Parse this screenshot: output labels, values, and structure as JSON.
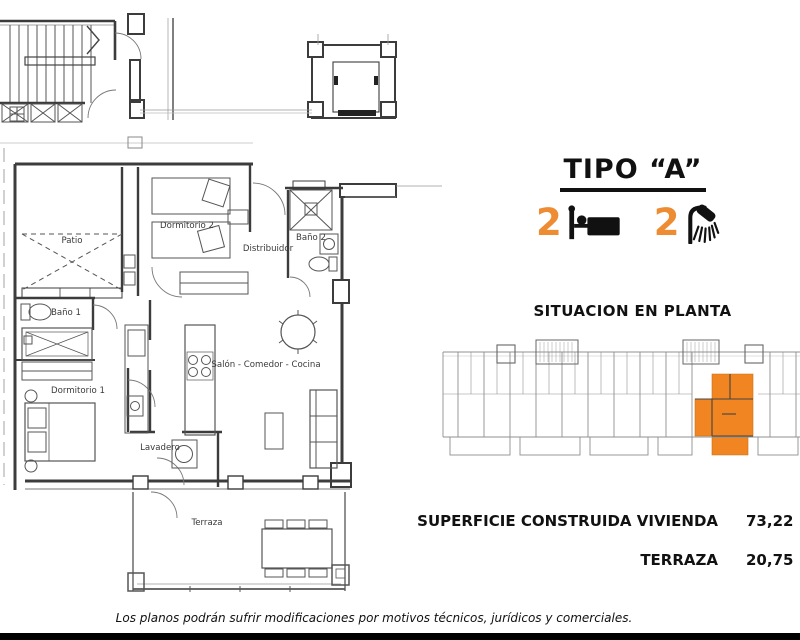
{
  "header": {
    "title": "TIPO “A”"
  },
  "features": {
    "bedrooms": "2",
    "bathrooms": "2",
    "bed_icon": "bed-icon",
    "shower_icon": "shower-icon"
  },
  "situation": {
    "heading": "SITUACION EN PLANTA"
  },
  "areas": {
    "vivienda_label": "SUPERFICIE CONSTRUIDA VIVIENDA",
    "vivienda_value": "73,22 M",
    "terraza_label": "TERRAZA",
    "terraza_value": "20,75 M"
  },
  "plan": {
    "labels": {
      "patio": "Patio",
      "dormitorio2": "Dormitorio 2",
      "bano2": "Baño 2",
      "distribuidor": "Distribuidor",
      "bano1": "Baño 1",
      "salon": "Salón - Comedor - Cocina",
      "dormitorio1": "Dormitorio 1",
      "lavadero": "Lavadero",
      "terraza": "Terraza"
    }
  },
  "footer": {
    "disclaimer": "Los planos podrán sufrir modificaciones por motivos técnicos, jurídicos y comerciales."
  },
  "colors": {
    "accent_orange": "#F08522",
    "digit_orange": "#EE8C33",
    "wall_dark": "#3c3c3c",
    "line_gray": "#909090"
  }
}
